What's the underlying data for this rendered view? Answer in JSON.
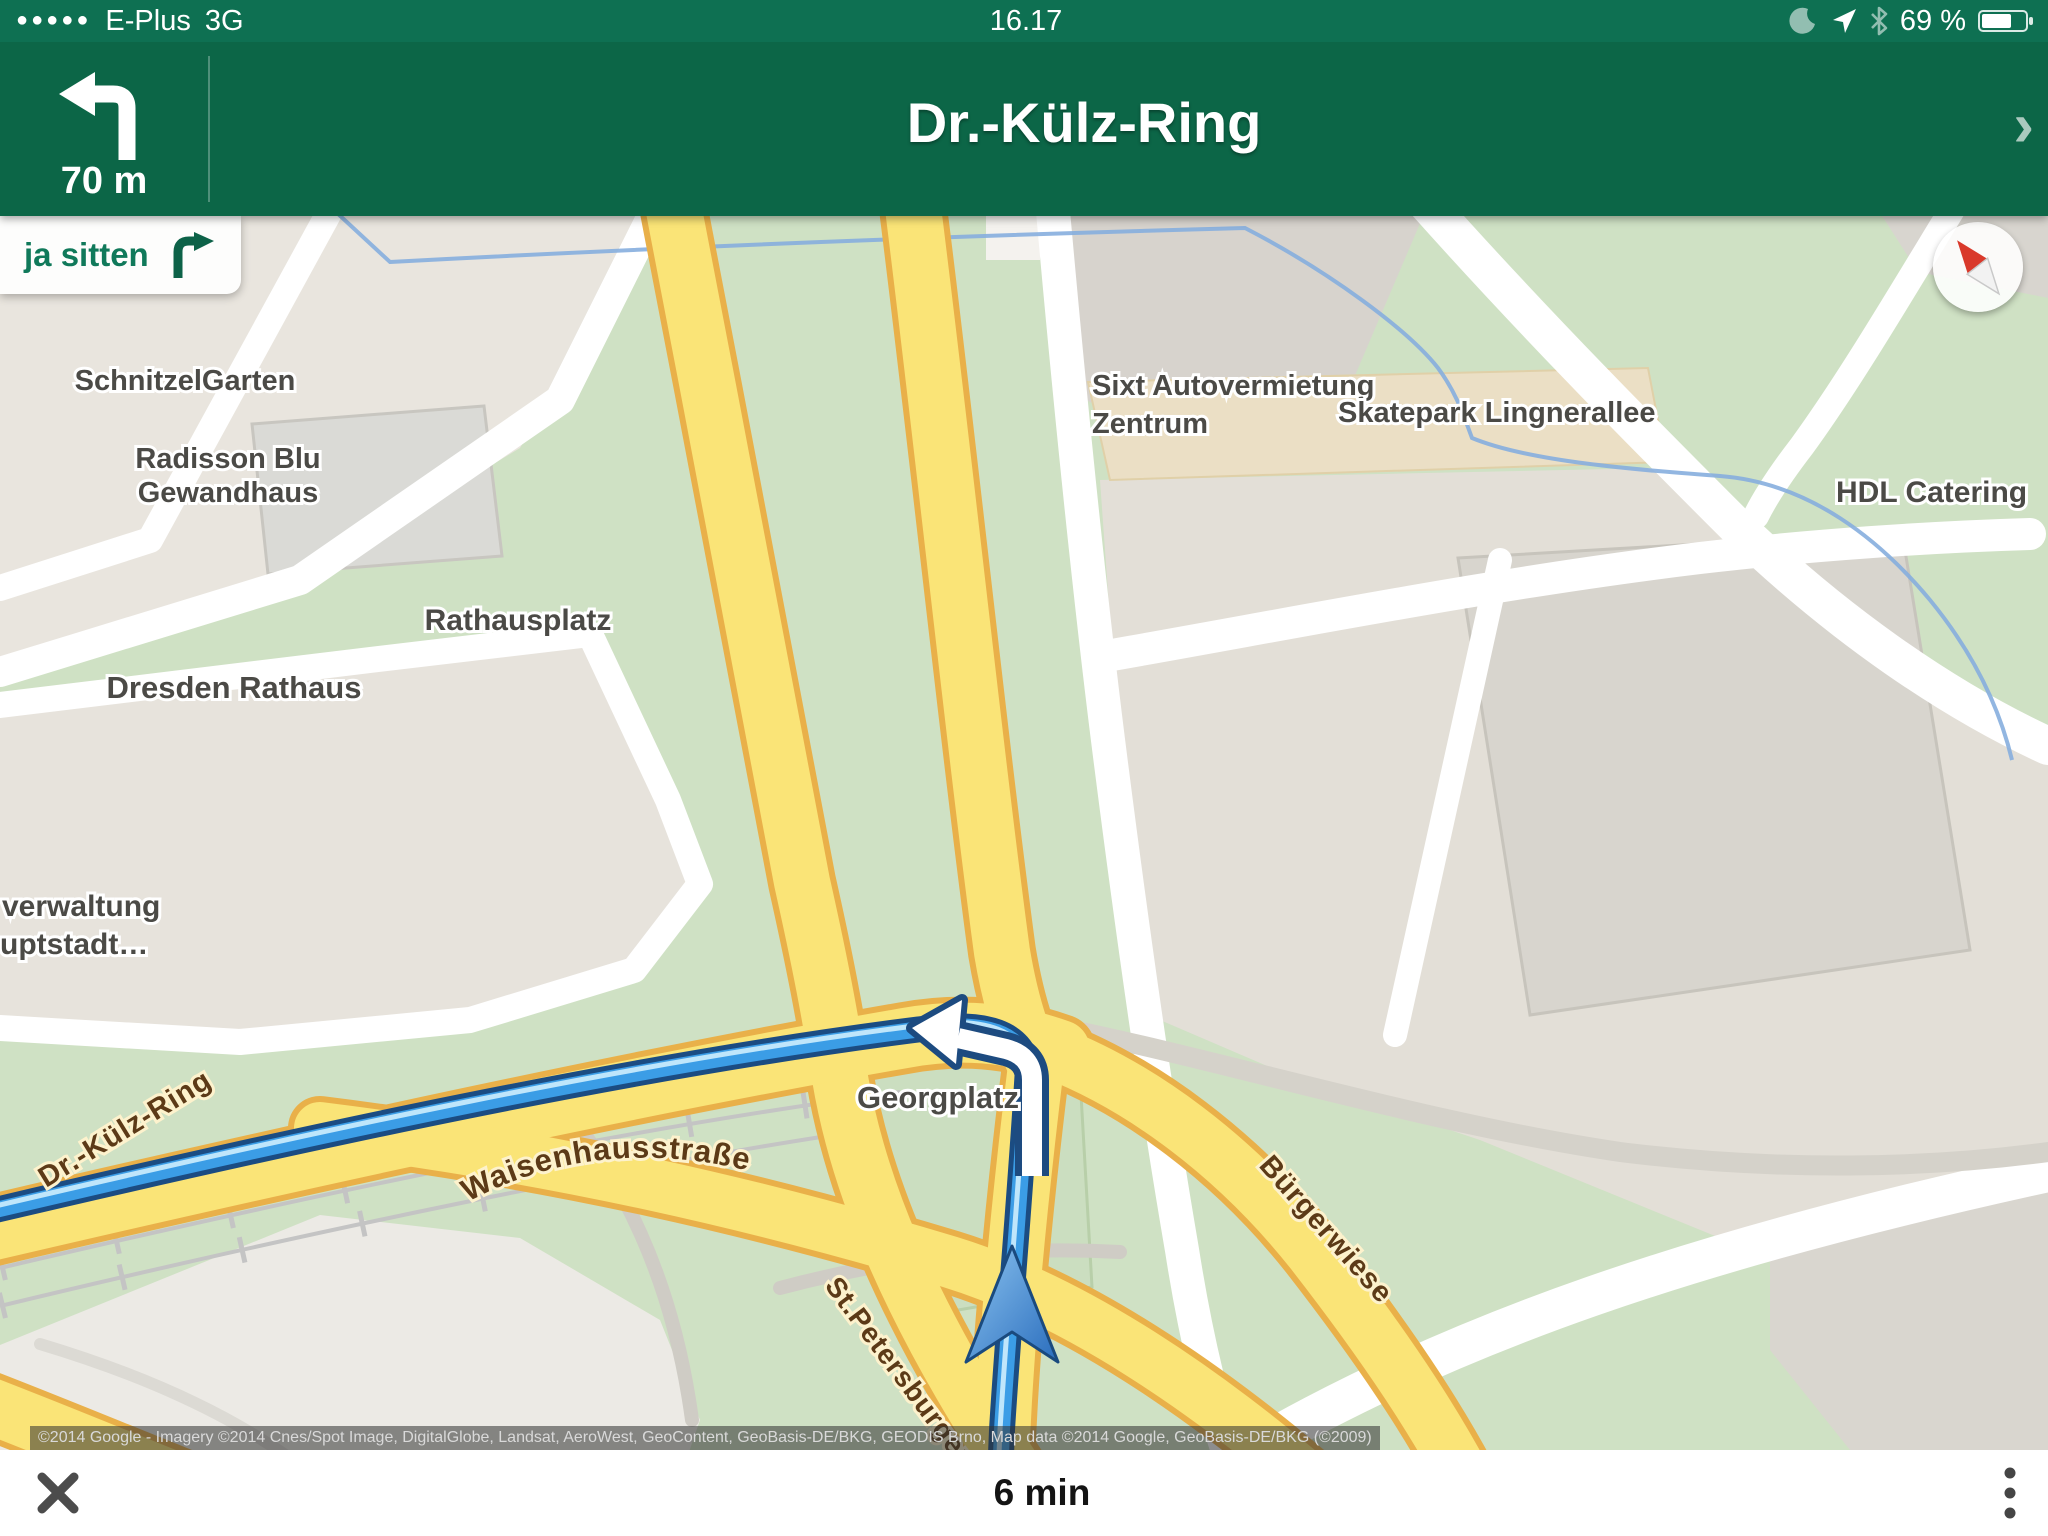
{
  "status_bar": {
    "signal_dots": "●●●●●",
    "carrier": "E-Plus",
    "network": "3G",
    "time": "16.17",
    "battery": "69 %"
  },
  "nav_header": {
    "distance": "70 m",
    "street": "Dr.-Külz-Ring",
    "chevron": "›"
  },
  "next_step": {
    "label": "ja sitten"
  },
  "map": {
    "poi_labels": {
      "schnitzelgarten": "SchnitzelGarten",
      "radisson_1": "Radisson Blu",
      "radisson_2": "Gewandhaus",
      "sixt_1": "Sixt Autovermietung",
      "sixt_2": "Zentrum",
      "skatepark": "Skatepark Lingnerallee",
      "hdl": "HDL Catering",
      "rathausplatz": "Rathausplatz",
      "dresden_rathaus": "Dresden Rathaus",
      "verwaltung_1": "verwaltung",
      "verwaltung_2": "uptstadt…",
      "georgplatz": "Georgplatz"
    },
    "street_labels": {
      "dr_kulz_ring": "Dr.-Külz-Ring",
      "waisenhausstrasse": "Waisenhausstraße",
      "st_petersburger": "St.Petersburger S",
      "buergerwiese": "Bürgerwiese"
    },
    "copyright": "©2014 Google - Imagery ©2014 Cnes/Spot Image, DigitalGlobe, Landsat, AeroWest, GeoContent, GeoBasis-DE/BKG, GEODIS Brno, Map data ©2014 Google, GeoBasis-DE/BKG (©2009)"
  },
  "bottom_bar": {
    "eta": "6 min"
  },
  "colors": {
    "header_green": "#0c6647",
    "status_green": "#0e7052",
    "route_blue": "#3b9de6",
    "road_yellow": "#fae477",
    "park_green": "#cfe1c4"
  }
}
